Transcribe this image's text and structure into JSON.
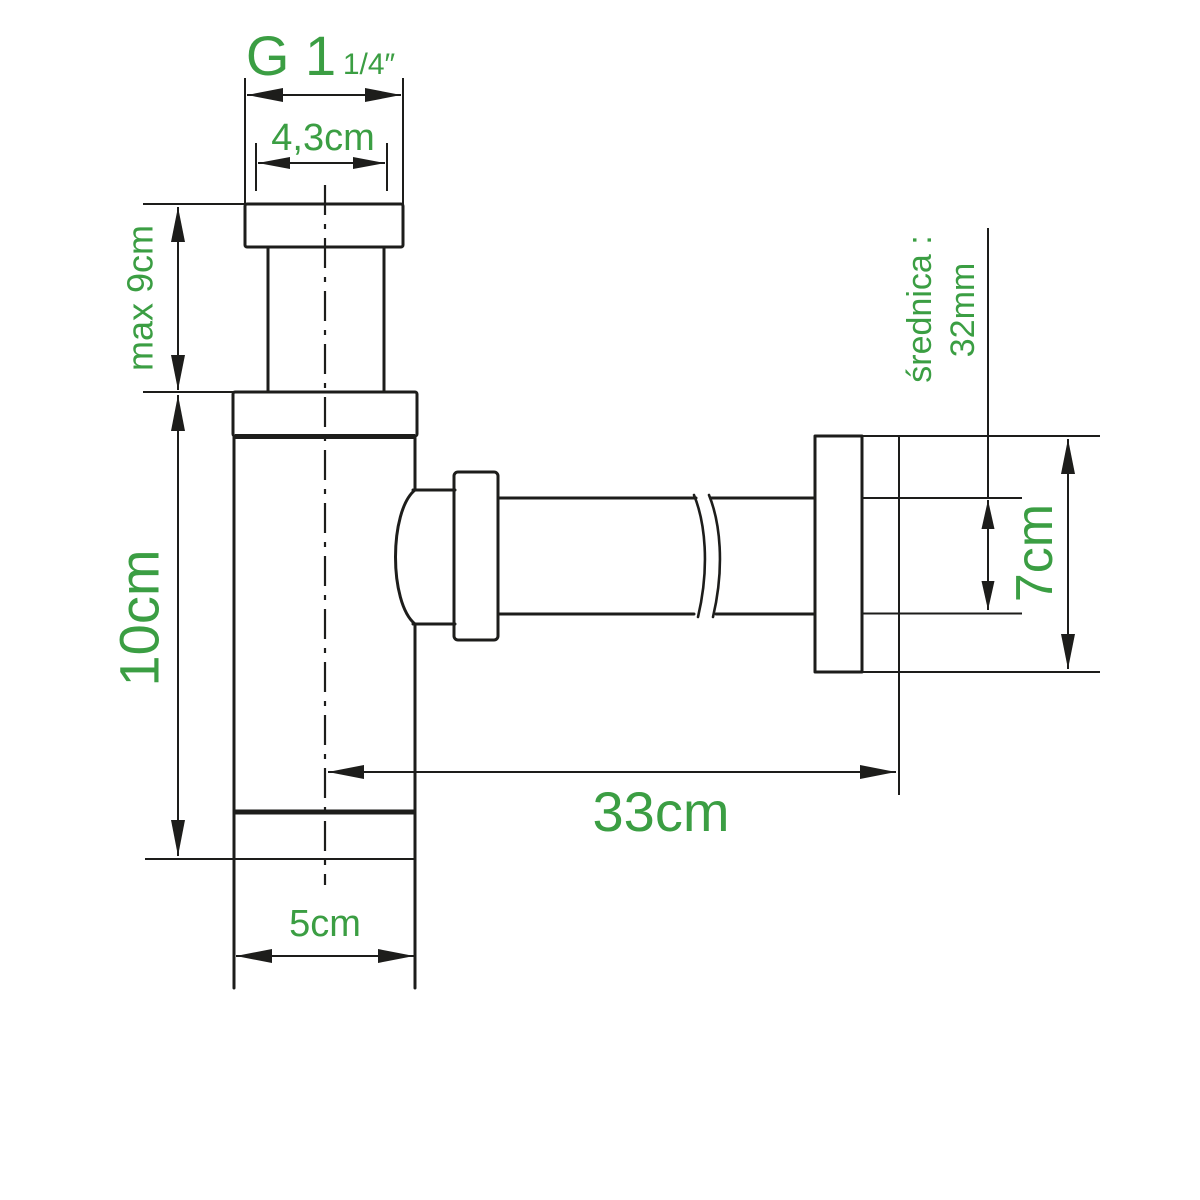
{
  "diagram": {
    "colors": {
      "dimension_text": "#3b9e43",
      "line": "#1d1d1b",
      "background": "#ffffff"
    },
    "labels": {
      "thread_main": "G 1",
      "thread_sub": "1/4″",
      "inlet_width": "4,3cm",
      "max_height": "max 9cm",
      "body_height": "10cm",
      "body_width": "5cm",
      "reach": "33cm",
      "wall_plate_height": "7cm",
      "diameter_caption": "średnica :",
      "diameter_value": "32mm"
    }
  }
}
